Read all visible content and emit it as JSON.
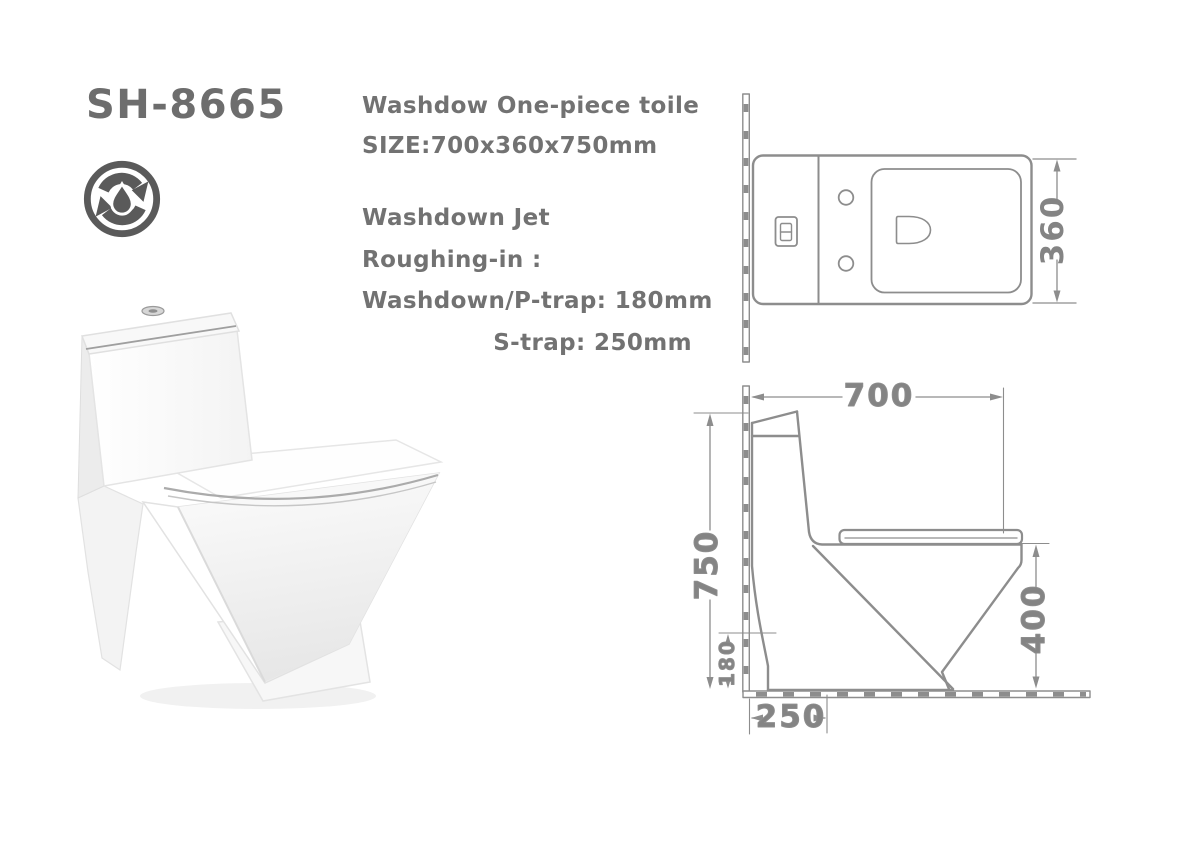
{
  "sheet": {
    "model": "SH-8665",
    "description": {
      "title": "Washdow One-piece toile",
      "size": "SIZE:700x360x750mm",
      "flush_type": "Washdown Jet",
      "roughing_label": "Roughing-in :",
      "p_trap": "Washdown/P-trap: 180mm",
      "s_trap": "S-trap: 250mm"
    },
    "icon": "water-saving-cycle-drop",
    "drawings": {
      "top_view": {
        "depth": "360"
      },
      "side_view": {
        "width": "700",
        "height": "750",
        "p_trap_roughin": "180",
        "bowl_height": "400",
        "s_trap_roughin": "250"
      }
    },
    "colors": {
      "text_gray": "#6e6e6e",
      "line_gray": "#8d8d8d",
      "dim_text_gray": "#848484",
      "icon_gray": "#5a5a5a",
      "background": "#ffffff"
    }
  }
}
